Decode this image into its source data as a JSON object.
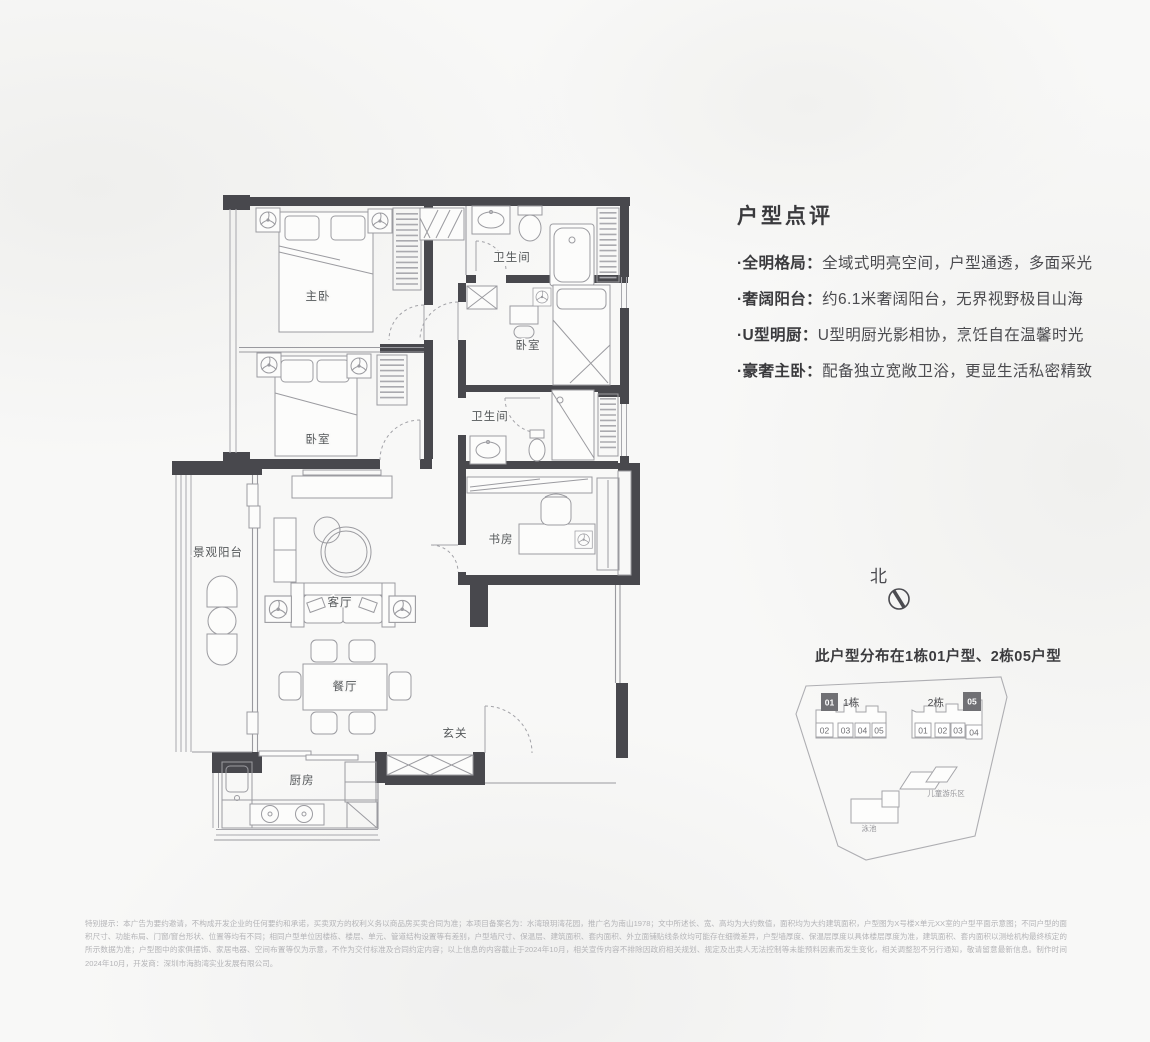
{
  "floor_plan": {
    "rooms": [
      {
        "label": "主卧"
      },
      {
        "label": "卫生间"
      },
      {
        "label": "卧室"
      },
      {
        "label": "卧室"
      },
      {
        "label": "卫生间"
      },
      {
        "label": "书房"
      },
      {
        "label": "景观阳台"
      },
      {
        "label": "客厅"
      },
      {
        "label": "餐厅"
      },
      {
        "label": "玄关"
      },
      {
        "label": "厨房"
      }
    ],
    "colors": {
      "wall": "#48484d",
      "furniture_line": "#9b9ba0"
    }
  },
  "review": {
    "title": "户型点评",
    "points": [
      {
        "label": "·全明格局：",
        "text": "全域式明亮空间，户型通透，多面采光"
      },
      {
        "label": "·奢阔阳台：",
        "text": "约6.1米奢阔阳台，无界视野极目山海"
      },
      {
        "label": "·U型明厨：",
        "text": "U型明厨光影相协，烹饪自在温馨时光"
      },
      {
        "label": "·豪奢主卧：",
        "text": "配备独立宽敞卫浴，更显生活私密精致"
      }
    ]
  },
  "compass": {
    "label": "北"
  },
  "site_plan": {
    "title": "此户型分布在1栋01户型、2栋05户型",
    "buildings": [
      {
        "name": "1栋",
        "highlight": "01",
        "units": [
          "02",
          "03",
          "04",
          "05"
        ]
      },
      {
        "name": "2栋",
        "highlight": "05",
        "units": [
          "01",
          "02",
          "03",
          "04"
        ]
      }
    ],
    "amenities": {
      "playground": "儿童游乐区",
      "pool": "泳池"
    },
    "highlight_color": "#707074"
  },
  "disclaimer": "特别提示：本广告为要约邀请，不构成开发企业的任何要约和承诺，买卖双方的权利义务以商品房买卖合同为准；本项目备案名为：水湾琅玥湾花园，推广名为南山1978；文中所述长、宽、高均为大约数值，面积均为大约建筑面积，户型图为X号楼X单元XX室的户型平面示意图；不同户型的面积尺寸、功能布局、门窗/窗台形状、位置等均有不同；相同户型单位因楼栋、楼层、单元、管道结构设置等有差别，户型墙尺寸、保温层、建筑面积、套内面积、外立面铺贴线条纹均可能存在细微差异，户型墙厚度、保温层厚度以具体楼层厚度为准，建筑面积、套内面积以测绘机构最终核定的所示数据为准；户型图中的家俱摆饰、家居电器、空间布置等仅为示意，不作为交付标准及合同约定内容；以上信息的内容截止于2024年10月，相关宣传内容不排除因政府相关规划、规定及出卖人无法控制等未能预料因素而发生变化，相关调整恕不另行通知，敬请留意最新信息。制作时间2024年10月，开发商：深圳市海韵湾实业发展有限公司。"
}
